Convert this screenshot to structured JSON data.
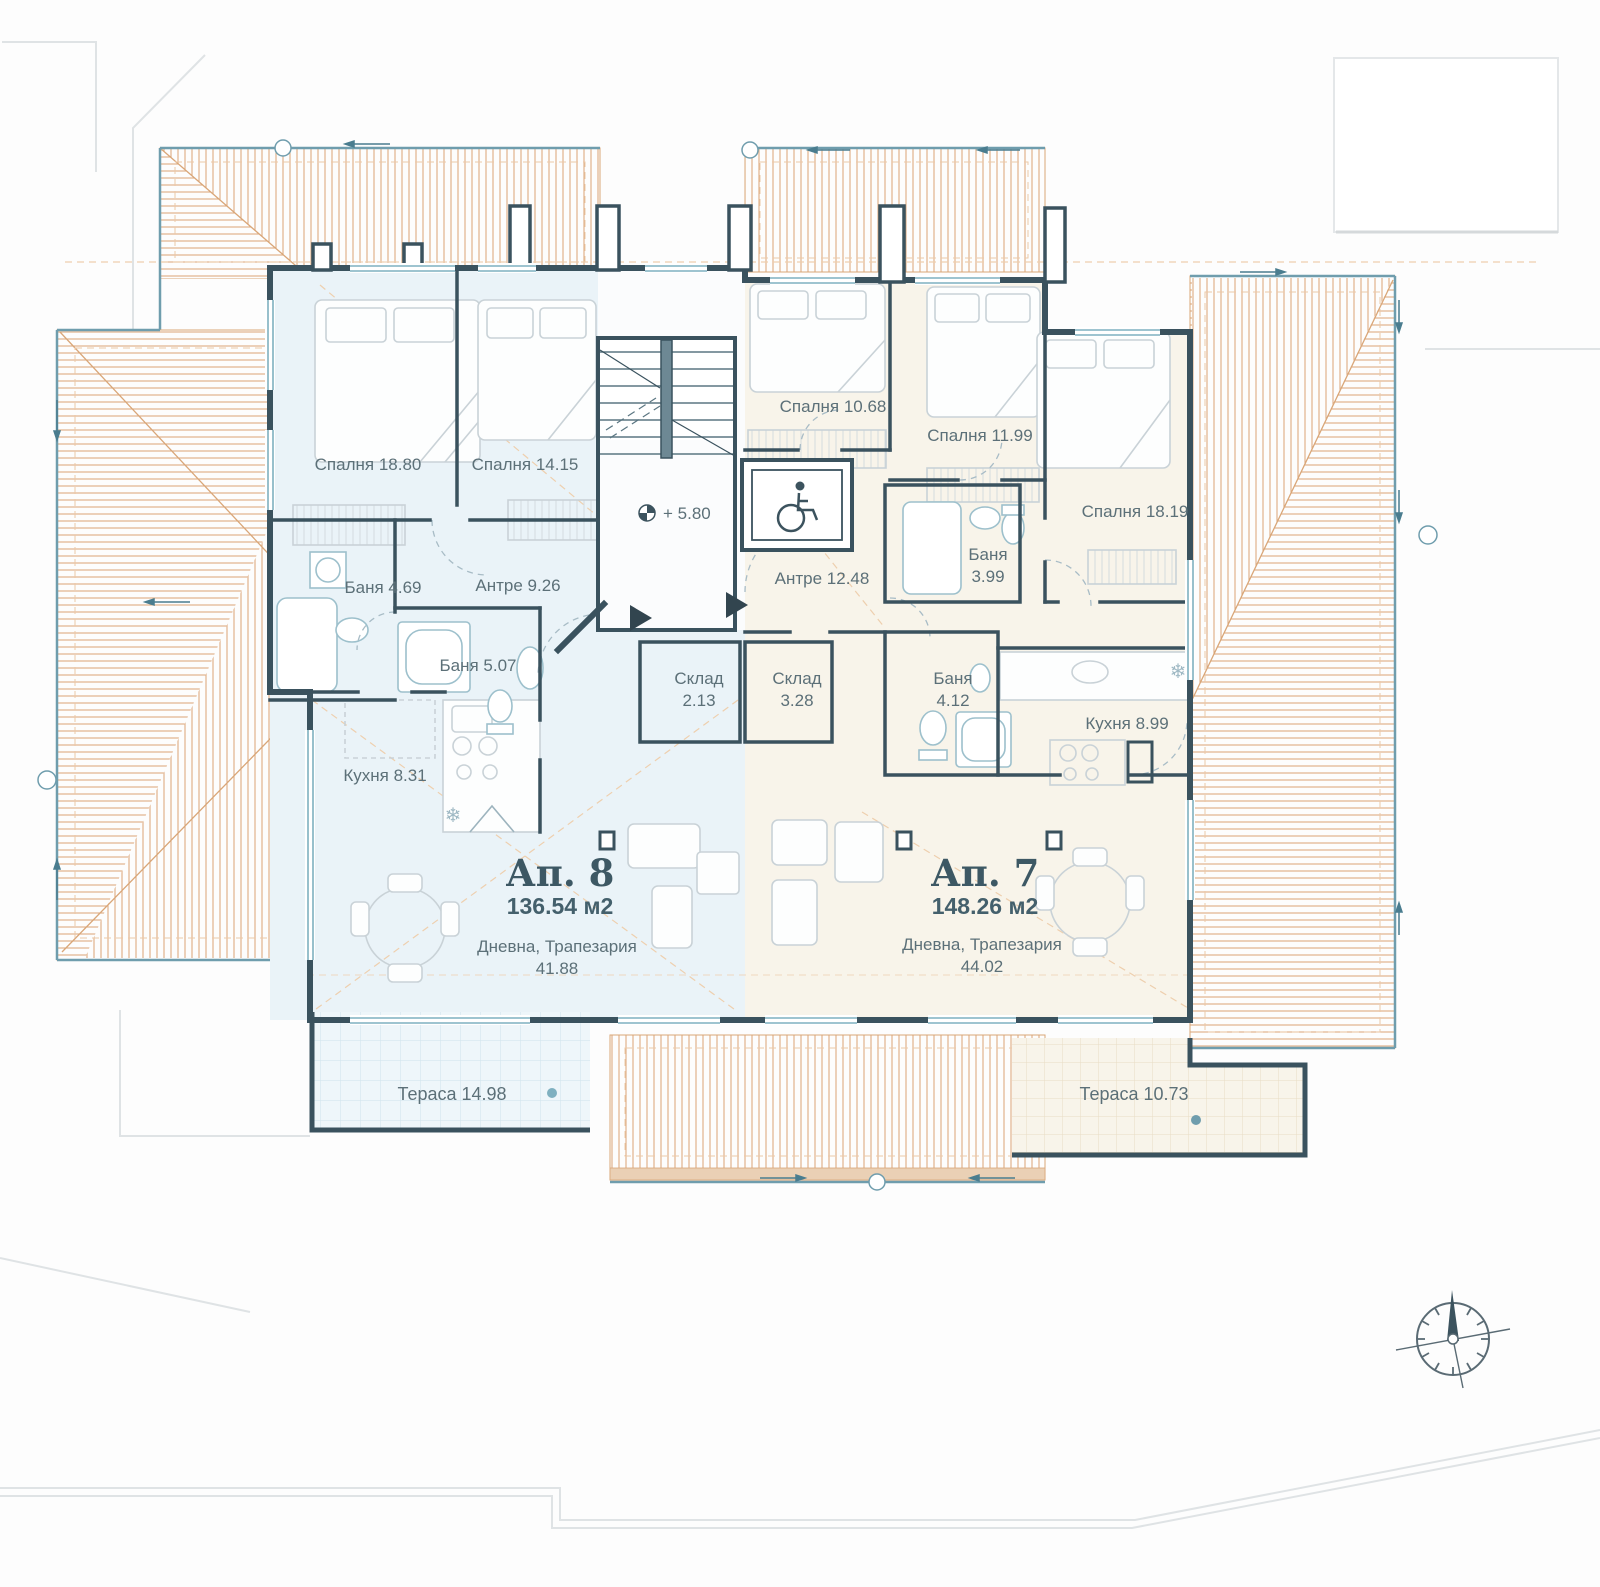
{
  "colors": {
    "wall": "#3a525e",
    "roof_hatch": "#dcaa80",
    "roof_edge": "#6f9dad",
    "ap8_fill": "#eaf3f8",
    "ap7_fill": "#f8f4ea",
    "label_text": "#5c7078",
    "title_text": "#3d5864",
    "furniture": "#c9d2d7",
    "site_line": "#dfe3e5"
  },
  "level_marker": "+ 5.80",
  "apartments": [
    {
      "name": "Ап. 8",
      "area": "136.54 м2",
      "living_room": "Дневна, Трапезария",
      "living_area": "41.88",
      "terrace": "Тераса 14.98"
    },
    {
      "name": "Ап. 7",
      "area": "148.26 м2",
      "living_room": "Дневна, Трапезария",
      "living_area": "44.02",
      "terrace": "Тераса 10.73"
    }
  ],
  "rooms": [
    {
      "label": "Спалня 18.80"
    },
    {
      "label": "Спалня 14.15"
    },
    {
      "label": "Баня  4.69"
    },
    {
      "label": "Антре 9.26"
    },
    {
      "label": "Баня  5.07"
    },
    {
      "label": "Кухня 8.31"
    },
    {
      "label": "Спалня 10.68"
    },
    {
      "label": "Спалня 11.99"
    },
    {
      "label": "Антре 12.48"
    },
    {
      "label": "Спалня 18.19"
    },
    {
      "label": "Кухня 8.99"
    }
  ],
  "rooms_two_line": [
    {
      "line1": "Баня",
      "line2": "3.99"
    },
    {
      "line1": "Склад",
      "line2": "2.13"
    },
    {
      "line1": "Склад",
      "line2": "3.28"
    },
    {
      "line1": "Баня",
      "line2": "4.12"
    }
  ]
}
